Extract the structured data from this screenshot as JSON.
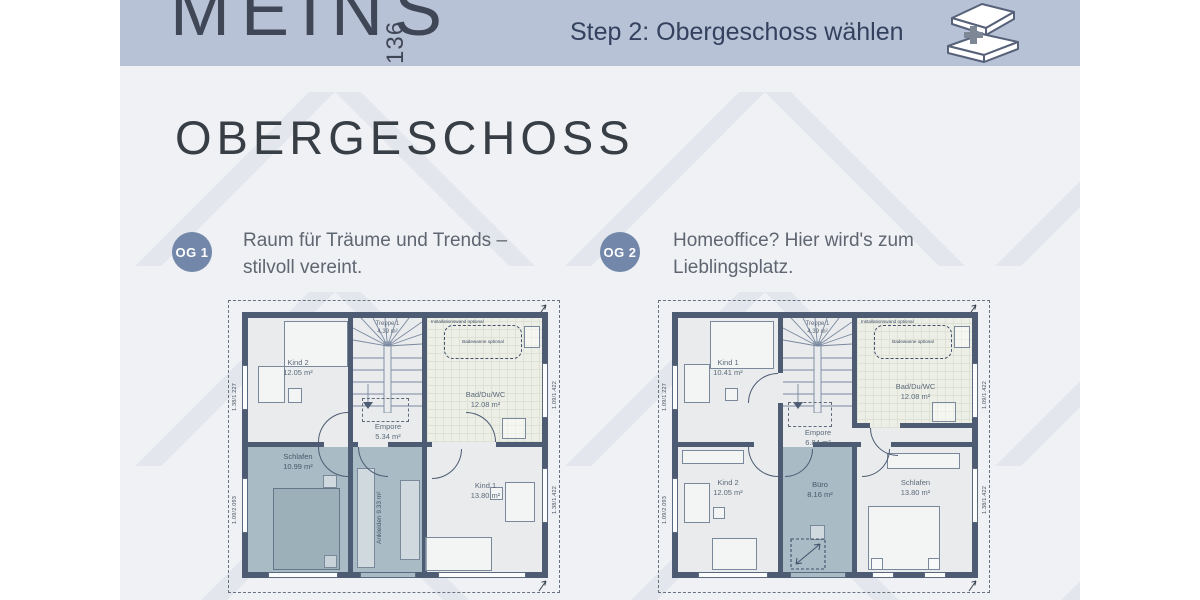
{
  "header": {
    "logo": "MEINS",
    "logo_number": "136",
    "step_label": "Step 2: Obergeschoss wählen"
  },
  "page": {
    "title": "OBERGESCHOSS"
  },
  "options": [
    {
      "badge": "OG 1",
      "description_line1": "Raum für Träume und Trends –",
      "description_line2": "stilvoll vereint."
    },
    {
      "badge": "OG 2",
      "description_line1": "Homeoffice? Hier wird's zum",
      "description_line2": "Lieblingsplatz."
    }
  ],
  "plans": [
    {
      "name": "OG 1",
      "rooms": {
        "kind2": {
          "name": "Kind 2",
          "area": "12.05 m²"
        },
        "treppe": {
          "name": "Treppe 1",
          "area": "4.39 m²"
        },
        "bad": {
          "name": "Bad/Du/WC",
          "area": "12.08 m²"
        },
        "empore": {
          "name": "Empore",
          "area": "5.34 m²"
        },
        "schlafen": {
          "name": "Schlafen",
          "area": "10.99 m²"
        },
        "ankleiden": {
          "name": "Ankleiden",
          "area": "9.33 m²"
        },
        "kind1": {
          "name": "Kind 1",
          "area": "13.80 m²"
        }
      },
      "notes": {
        "installationswand": "Installationswand optional",
        "badewanne": "Badewanne optional"
      },
      "dims": {
        "left_top": "1.38/1.227",
        "left_bottom": "1.09/2.093",
        "right_top": "1.09/1.422",
        "right_bottom": "1.38/1.422"
      }
    },
    {
      "name": "OG 2",
      "rooms": {
        "kind1": {
          "name": "Kind 1",
          "area": "10.41 m²"
        },
        "treppe": {
          "name": "Treppe 1",
          "area": "4.39 m²"
        },
        "bad": {
          "name": "Bad/Du/WC",
          "area": "12.08 m²"
        },
        "empore": {
          "name": "Empore",
          "area": "6.84 m²"
        },
        "kind2": {
          "name": "Kind 2",
          "area": "12.05 m²"
        },
        "buero": {
          "name": "Büro",
          "area": "8.16 m²"
        },
        "schlafen": {
          "name": "Schlafen",
          "area": "13.80 m²"
        }
      },
      "notes": {
        "installationswand": "Installationswand optional",
        "badewanne": "Badewanne optional"
      },
      "dims": {
        "left_top": "1.09/1.227",
        "left_bottom": "1.09/2.093",
        "right_top": "1.09/1.422",
        "right_bottom": "1.38/1.422"
      }
    }
  ],
  "colors": {
    "header_bg": "#b7c2d6",
    "badge": "#7287a9",
    "wall": "#4d5c73",
    "room_shaded": "#a9bbc4",
    "background": "#eff1f4"
  }
}
